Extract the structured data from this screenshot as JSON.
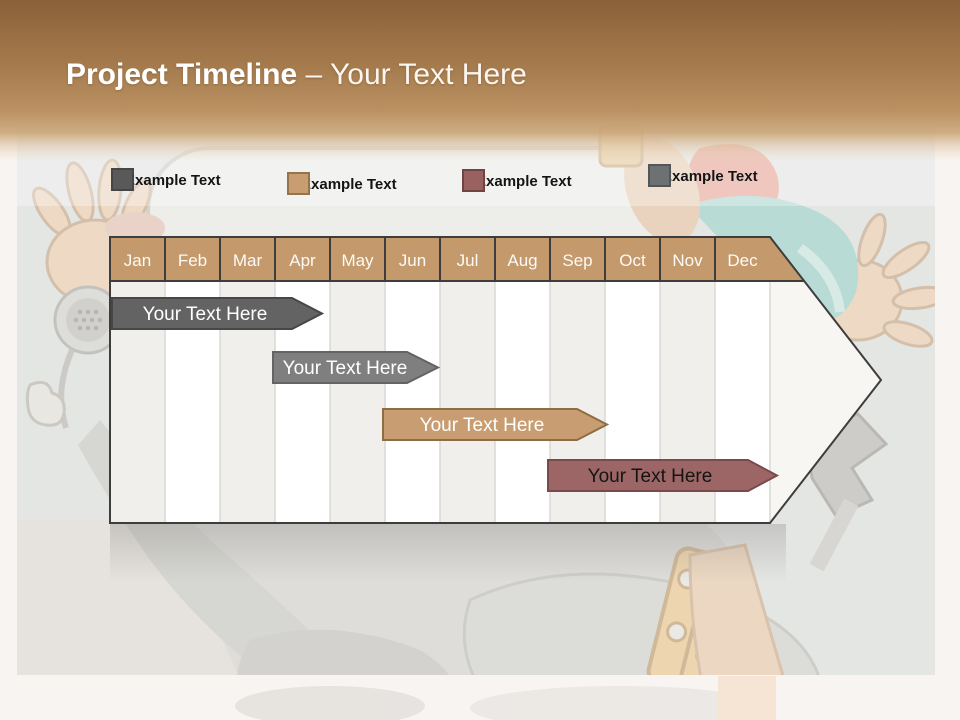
{
  "title": {
    "primary": "Project Timeline",
    "secondary": "– Your Text Here"
  },
  "legend": {
    "items": [
      {
        "label": "Example Text",
        "color": "#595959",
        "border": "#454545"
      },
      {
        "label": "Example Text",
        "color": "#c79d71",
        "border": "#96744b"
      },
      {
        "label": "Example Text",
        "color": "#9a6161",
        "border": "#714444"
      },
      {
        "label": "Example Text",
        "color": "#6e7171",
        "border": "#535656"
      }
    ]
  },
  "timeline": {
    "header_fill": "#c49a6c",
    "header_border": "#3d3d3d",
    "body_stripe_color": "#f0efec",
    "body_base_color": "#f7f6f3"
  },
  "chart_data": {
    "type": "bar",
    "subtype": "gantt_timeline_arrow",
    "title": "Project Timeline – Your Text Here",
    "categories": [
      "Jan",
      "Feb",
      "Mar",
      "Apr",
      "May",
      "Jun",
      "Jul",
      "Aug",
      "Sep",
      "Oct",
      "Nov",
      "Dec"
    ],
    "xlabel": "Months of year",
    "legend_position": "top",
    "gridlines": "vertical month columns, alternating shading",
    "series": [
      {
        "name": "Your Text Here",
        "row": 1,
        "start": "Jan",
        "end": "Apr",
        "start_month": 1.0,
        "end_month": 4.4,
        "color": "#636363",
        "border": "#474747",
        "text_color": "#ffffff"
      },
      {
        "name": "Your Text Here",
        "row": 2,
        "start": "Apr",
        "end": "Jul",
        "start_month": 4.0,
        "end_month": 7.0,
        "color": "#7f7f7f",
        "border": "#646464",
        "text_color": "#ffffff"
      },
      {
        "name": "Your Text Here",
        "row": 3,
        "start": "Jun",
        "end": "Oct",
        "start_month": 6.0,
        "end_month": 10.0,
        "color": "#c79d71",
        "border": "#8f6d44",
        "text_color": "#ffffff"
      },
      {
        "name": "Your Text Here",
        "row": 4,
        "start": "Sep",
        "end": "Dec",
        "start_month": 9.0,
        "end_month": 13.1,
        "color": "#9d6666",
        "border": "#7a4a4a",
        "text_color": "#141414"
      }
    ]
  }
}
